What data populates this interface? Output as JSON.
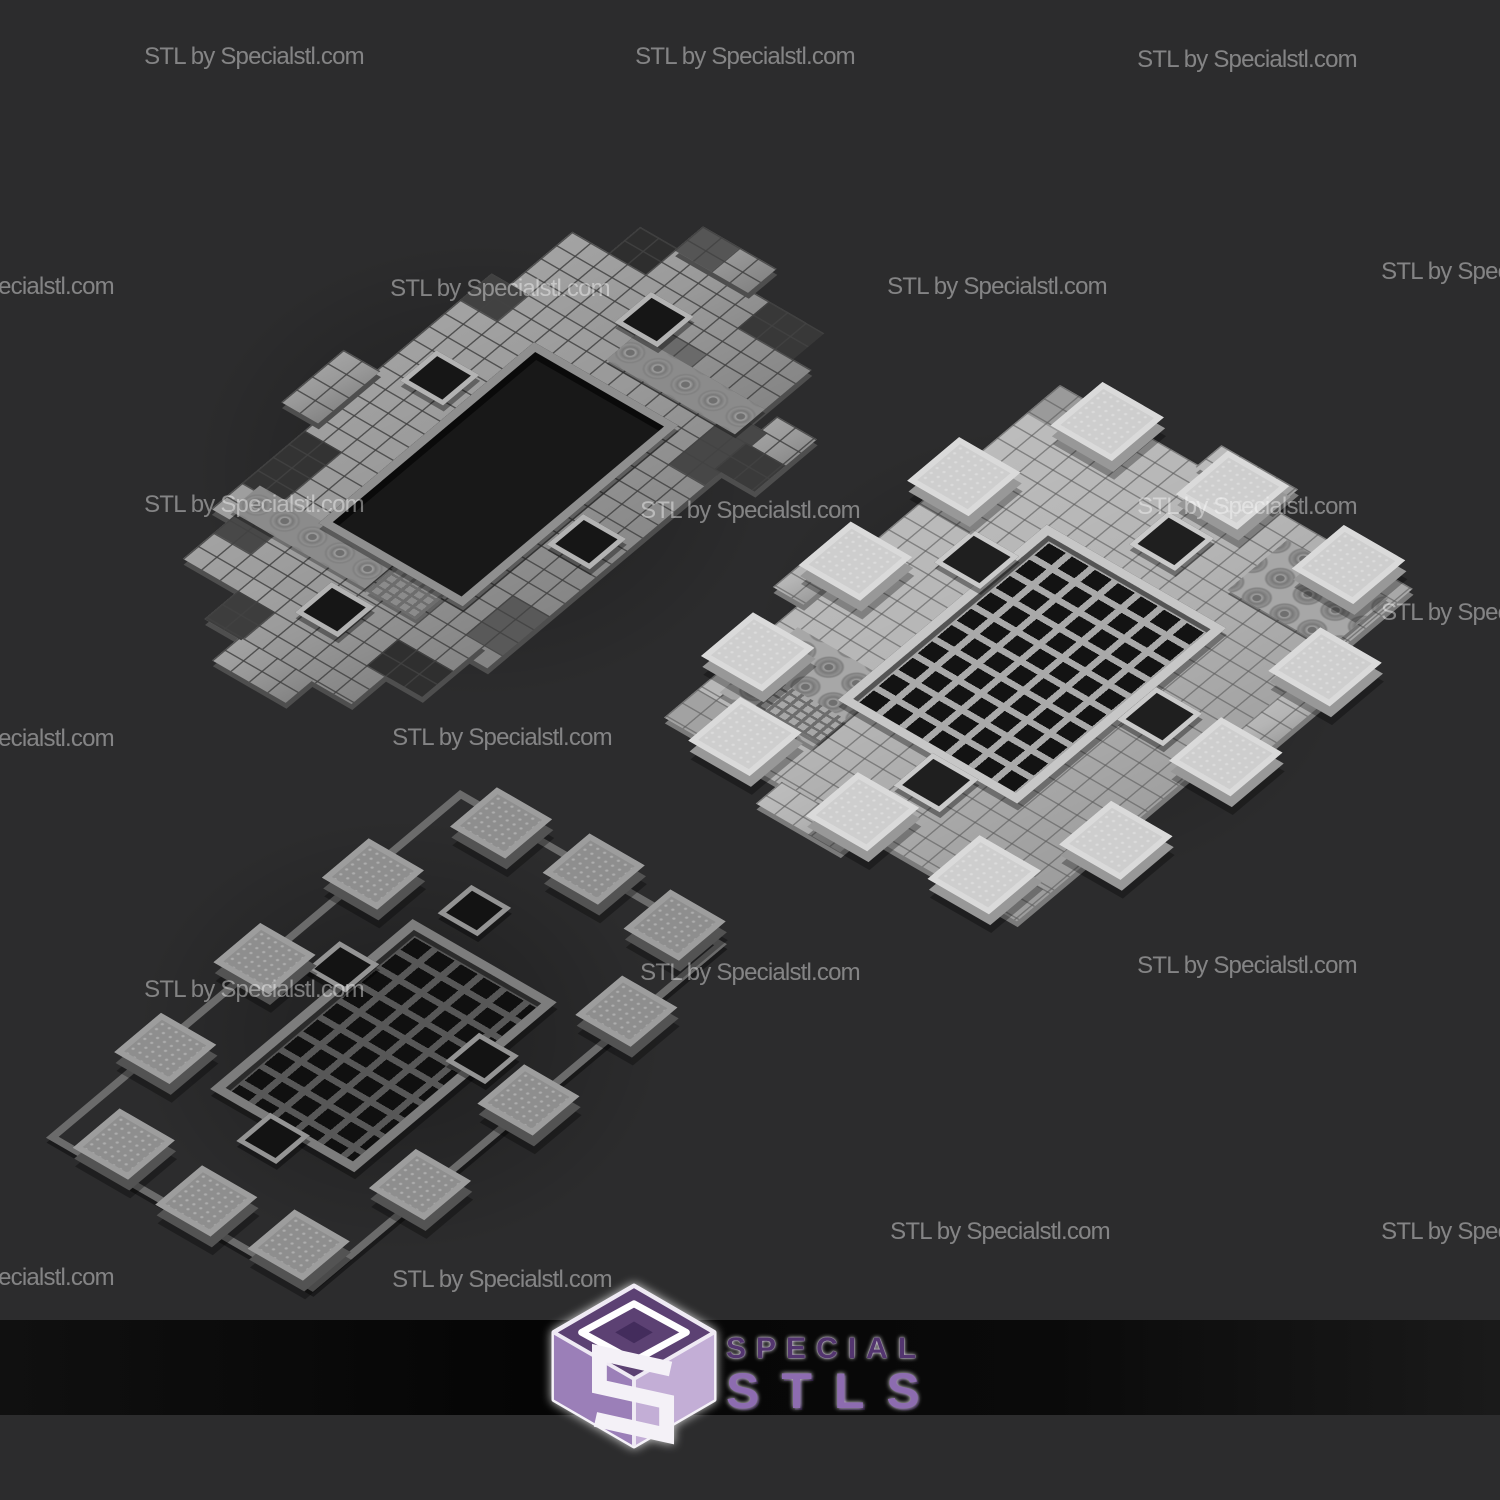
{
  "scene": {
    "description": "Watermarked grayscale 3D renders of a modular dungeon tile floor set, shown in three configurations",
    "background_color": "#2c2c2d",
    "footer_band_color": "#080808"
  },
  "watermark": {
    "text": "STL by Specialstl.com",
    "color": "rgba(255,255,255,0.42)"
  },
  "logo": {
    "line1": "SPECIAL",
    "line2": "STLS",
    "accent_dark_purple": "#53356f",
    "accent_light_purple": "#8d6cb0",
    "cube_top_color": "#5c4173",
    "cube_left_color": "#9b7fb8",
    "cube_right_color": "#c3aed6"
  },
  "renders": [
    {
      "label": "assembled tiled floor with central pit, top left"
    },
    {
      "label": "bright tiled floor with perimeter pillars and central grate, right"
    },
    {
      "label": "dark skeleton layout of pillars, rails and grate, bottom left"
    }
  ]
}
